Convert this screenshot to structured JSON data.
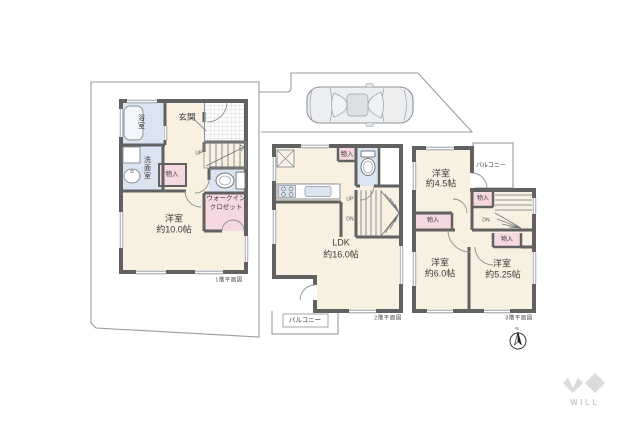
{
  "floors": {
    "f1": {
      "caption": "1階平面図",
      "bath": "浴室",
      "entrance": "玄関",
      "washroom": "洗面室",
      "storage": "物入",
      "wic_line1": "ウォークイン",
      "wic_line2": "クロゼット",
      "stairs_up": "UP",
      "room_name": "洋室",
      "room_size": "約10.0帖"
    },
    "f2": {
      "caption": "2階平面図",
      "storage": "物入",
      "stairs_up": "UP",
      "stairs_down": "DN",
      "room_name": "LDK",
      "room_size": "約16.0帖",
      "balcony": "バルコニー"
    },
    "f3": {
      "caption": "3階平面図",
      "room1_name": "洋室",
      "room1_size": "約4.5帖",
      "room2_name": "洋室",
      "room2_size": "約6.0帖",
      "room3_name": "洋室",
      "room3_size": "約5.25帖",
      "balcony": "バルコニー",
      "storage_top": "物入",
      "storage_left": "物入",
      "storage_right": "物入",
      "stairs_down": "DN"
    }
  },
  "compass": {
    "label": "N"
  },
  "logo": {
    "text": "WILL"
  },
  "colors": {
    "wall": "#616161",
    "room_cream": "#f8f0e1",
    "water_blue": "#dbe5f2",
    "closet_pink": "#f6d8e0",
    "thin_line": "#8b9096",
    "site_line": "#9b9b9b",
    "logo_gray": "#dbdbdb"
  }
}
